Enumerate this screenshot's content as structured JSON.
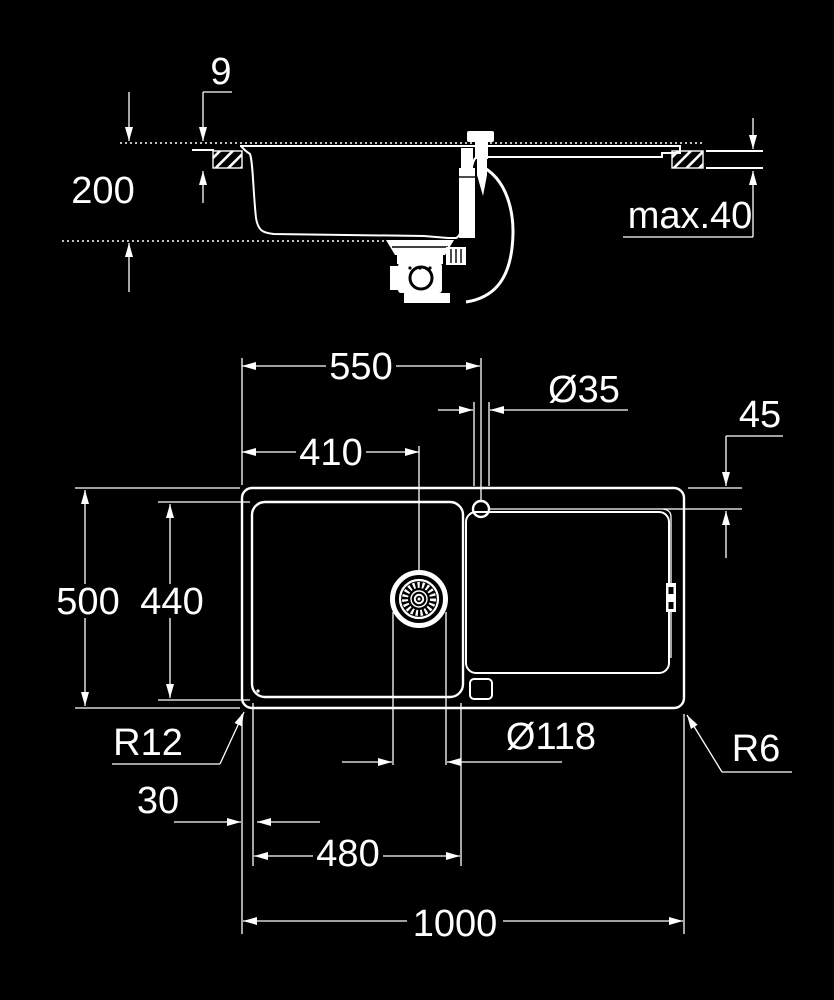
{
  "side_view": {
    "rim_above_counter": "9",
    "bowl_depth": "200",
    "counter_thickness_max": "max.40"
  },
  "top_view": {
    "faucet_from_left": "550",
    "faucet_hole_diameter": "Ø35",
    "faucet_from_top_edge": "45",
    "drain_from_left": "410",
    "overall_depth": "500",
    "bowl_inner_depth": "440",
    "bowl_corner_radius": "R12",
    "drain_diameter": "Ø118",
    "outer_corner_radius": "R6",
    "edge_to_bowl": "30",
    "bowl_inner_width": "480",
    "overall_width": "1000"
  }
}
